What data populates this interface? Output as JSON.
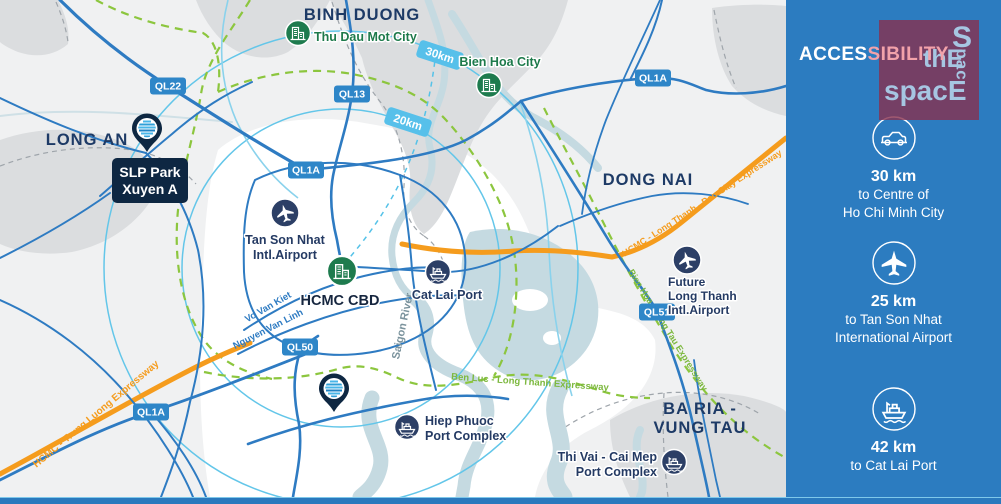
{
  "colors": {
    "sidebar_blue": "#2c7cc0",
    "map_background": "#f0f1f2",
    "road_blue": "#2e7bc2",
    "ring_cyan": "#63c6e9",
    "green_dash": "#8cc63e",
    "expressway_orange": "#f59c1d",
    "label_navy": "#1d3a66",
    "city_green": "#1d7a4b",
    "badge_blue": "#2e86c8",
    "km_badge_blue": "#57c0ea",
    "logo_maroon": "#882f4e",
    "logo_text_blue": "#a6c6e2",
    "pin_navy": "#0e2742",
    "title_pink": "#f2a2aa"
  },
  "sidebar": {
    "title_white": "ACCES",
    "title_pink": "SIBILITY",
    "logo": {
      "s": "S",
      "vertical": "pac",
      "the": "thE",
      "space": "spacE"
    },
    "items": [
      {
        "icon": "car-in-circle",
        "distance": "30 km",
        "line1": "to Centre of",
        "line2": "Ho Chi Minh City"
      },
      {
        "icon": "plane-in-circle",
        "distance": "25 km",
        "line1": "to Tan Son Nhat",
        "line2": "International Airport"
      },
      {
        "icon": "ship-in-circle",
        "distance": "42 km",
        "line1": "to Cat Lai Port",
        "line2": ""
      }
    ]
  },
  "map": {
    "regions": {
      "long_an": "LONG AN",
      "binh_duong": "BINH DUONG",
      "dong_nai": "DONG NAI",
      "ba_ria_1": "BA RIA -",
      "ba_ria_2": "VUNG TAU"
    },
    "cities": {
      "thu_dau_mot": "Thu Dau Mot City",
      "bien_hoa": "Bien Hoa City",
      "cbd": "HCMC CBD"
    },
    "facilities": {
      "tsn_1": "Tan Son Nhat",
      "tsn_2": "Intl.Airport",
      "cat_lai": "Cat Lai Port",
      "flt_1": "Future",
      "flt_2": "Long Thanh",
      "flt_3": "Intl.Airport",
      "hp_1": "Hiep Phuoc",
      "hp_2": "Port Complex",
      "tv_1": "Thi Vai - Cai Mep",
      "tv_2": "Port Complex"
    },
    "pin": {
      "line1": "SLP Park",
      "line2": "Xuyen A"
    },
    "badges": {
      "ql22": "QL22",
      "ql13": "QL13",
      "ql1a": "QL1A",
      "ql50": "QL50",
      "ql51": "QL51"
    },
    "rings": {
      "r20": "20km",
      "r30": "30km"
    },
    "roads": {
      "vo_van_kiet": "Vo Van Kiet",
      "nguyen_van_linh": "Nguyen Van Linh"
    },
    "expressways": {
      "trung_luong": "HCMC - Trung Luong Expressway",
      "ltdg": "HCMC - Long Thanh - Dau Giay Expressway",
      "ben_luc": "Ben Luc - Long Thanh Expressway",
      "bhvt": "Bien Hoa - Vung Tau  Expressway"
    },
    "river": "Saigon  River"
  }
}
